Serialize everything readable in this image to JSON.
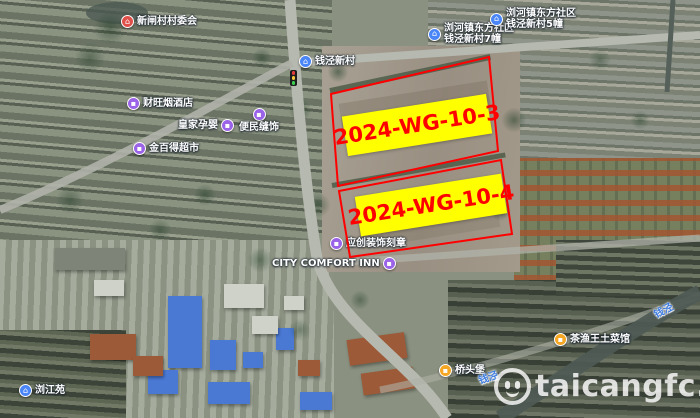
{
  "parcels": [
    {
      "label": "2024-WG-10-3"
    },
    {
      "label": "2024-WG-10-4"
    }
  ],
  "pois": [
    {
      "l1": "新闸村村委会",
      "type": "village-committee"
    },
    {
      "l1": "钱泾新村",
      "type": "residential-community"
    },
    {
      "l1": "浏河镇东方社区",
      "l2": "钱泾新村7幢",
      "type": "residential-building"
    },
    {
      "l1": "浏河镇东方社区",
      "l2": "钱泾新村5幢",
      "type": "residential-building"
    },
    {
      "l1": "财旺烟酒店",
      "type": "shop"
    },
    {
      "l1": "皇家孕婴",
      "type": "shop"
    },
    {
      "l1": "便民缝饰",
      "type": "shop"
    },
    {
      "l1": "金百得超市",
      "type": "shop"
    },
    {
      "l1": "应创装饰刻章",
      "type": "shop"
    },
    {
      "l1": "CITY COMFORT INN",
      "type": "hotel"
    },
    {
      "l1": "桥头堡",
      "type": "restaurant"
    },
    {
      "l1": "茶渔王土菜馆",
      "type": "restaurant"
    },
    {
      "l1": "浏江苑",
      "type": "residential-community"
    }
  ],
  "waterways": [
    {
      "name": "钱泾"
    },
    {
      "name": "钱泾"
    }
  ],
  "watermark": {
    "text": "taicangfc.com"
  },
  "icons": {
    "home_glyph": "⌂",
    "shop_glyph": "▪",
    "food_glyph": "▪"
  },
  "colors": {
    "parcel_outline": "#ff0000",
    "parcel_label_bg": "#ffff00",
    "parcel_label_text": "#ff0000",
    "poi_icon_red": "#e0504a",
    "poi_icon_blue": "#4a86f7",
    "poi_icon_purple": "#9b63e8",
    "poi_icon_orange": "#f5a623",
    "water_label_blue": "#3f7de0"
  }
}
